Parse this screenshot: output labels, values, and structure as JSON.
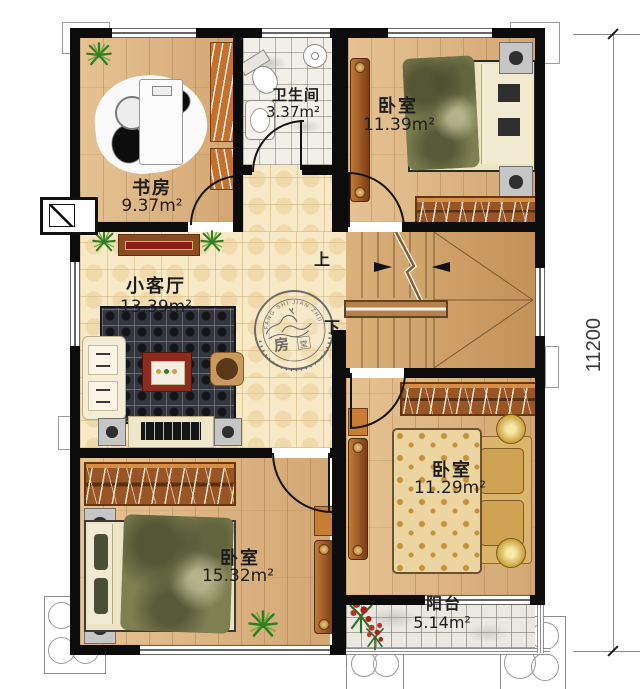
{
  "rooms": {
    "study": {
      "name": "书房",
      "area": "9.37m²"
    },
    "bathroom": {
      "name": "卫生间",
      "area": "3.37m²"
    },
    "bedroom_top_right": {
      "name": "卧室",
      "area": "11.39m²"
    },
    "living_room": {
      "name": "小客厅",
      "area": "13.39m²"
    },
    "bedroom_bottom_left": {
      "name": "卧室",
      "area": "15.32m²"
    },
    "bedroom_bottom_right": {
      "name": "卧室",
      "area": "11.29m²"
    },
    "balcony": {
      "name": "阳台",
      "area": "5.14m²"
    }
  },
  "stairs": {
    "up_label": "上",
    "down_label": "下"
  },
  "annotations": {
    "height_dimension": "11200"
  },
  "stamp": {
    "arc_text": "FANG SHI JIAN ZHU SHE JI",
    "char_main": "房",
    "char_sub": "堂"
  },
  "colors": {
    "wall": "#0c0c0c",
    "wood_floor": "#dcb27e",
    "tile_floor": "#f7e8c6",
    "stair_wood": "#cf9e63",
    "accent_red": "#8c2b1e",
    "closet_brown": "#9a5526"
  }
}
